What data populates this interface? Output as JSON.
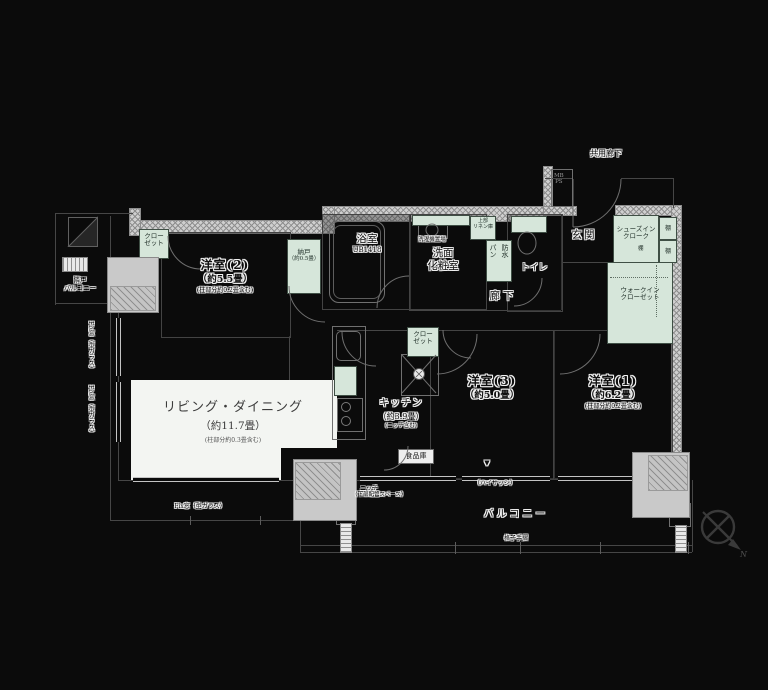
{
  "canvas": {
    "width": 768,
    "height": 690,
    "background": "#0b0b0b"
  },
  "colors": {
    "wall_hatch": "#cfcfcf",
    "fixture_mint": "#d6e6da",
    "living_fill": "#f3f5f2",
    "pillar_gray": "#c9c9c9",
    "label_halo": "#f2f2f2"
  },
  "rooms": {
    "living": {
      "name": "リビング・ダイニング",
      "size": "（約11.7畳）",
      "note": "(柱部分約0.3畳含む)"
    },
    "bedroom2": {
      "name": "洋室(2)",
      "size": "（約5.5畳）",
      "note": "(柱部分約0.2畳含む)"
    },
    "bedroom3": {
      "name": "洋室(3)",
      "size": "（約5.0畳）"
    },
    "bedroom1": {
      "name": "洋室(1)",
      "size": "（約6.2畳）",
      "note": "(柱部分約0.2畳含む)"
    },
    "kitchen": {
      "name": "キッチン",
      "size": "（約3.9畳）",
      "note": "(ニッチ含む)"
    },
    "bath": {
      "name": "浴室",
      "spec": "UB1418"
    },
    "washroom": {
      "line1": "洗面",
      "line2": "化粧室"
    },
    "toilet": {
      "name": "トイレ"
    },
    "hallway": {
      "name": "廊下"
    },
    "entrance": {
      "name": "玄関"
    },
    "storage_nando": {
      "name": "納戸",
      "size": "（約0.5畳）"
    }
  },
  "closets": {
    "closet_line1": "クロー",
    "closet_line2": "ゼット",
    "shoes_in_line1": "シューズイン",
    "shoes_in_line2": "クローク",
    "walk_in_line1": "ウォークイン",
    "walk_in_line2": "クローゼット",
    "shelf": "棚",
    "pantry": "食品庫",
    "linen_line1": "上部",
    "linen_line2": "リネン庫"
  },
  "fixtures": {
    "waterproof_pan_col1": "防水",
    "waterproof_pan_col2": "パン",
    "washer": "洗濯機置場",
    "meter_box_line1": "MB",
    "meter_box_line2": "PS"
  },
  "outdoor": {
    "balcony": "バルコニー",
    "neighbor_line1": "隣戸",
    "neighbor_line2": "バルコニー",
    "common_corridor": "共用廊下",
    "high_sash": "（ハイサッシ）",
    "railing": "格子手摺",
    "niche_line1": "ニッチ",
    "niche_line2": "（下部配管スペース）",
    "fix_window": "Fix窓（型ガラス）",
    "window_mark": "▼",
    "compass_north": "N"
  }
}
